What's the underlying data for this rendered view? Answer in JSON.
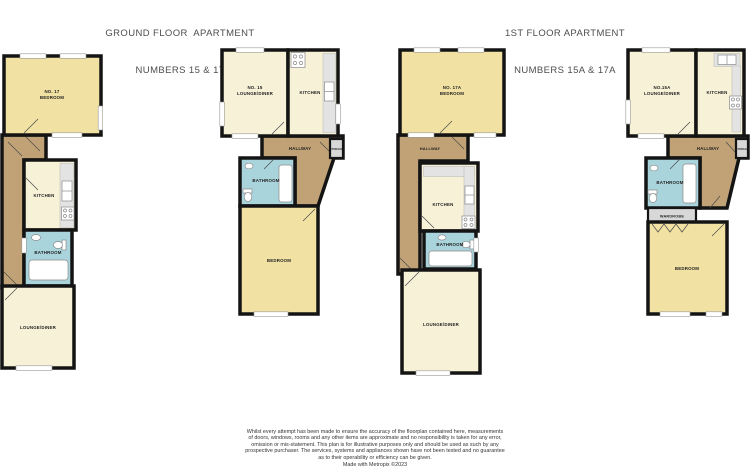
{
  "titles": [
    {
      "line1": "GROUND FLOOR  APARTMENT",
      "line2": "NUMBERS 15 & 17"
    },
    {
      "line1": "1ST FLOOR APARTMENT",
      "line2": "NUMBERS 15A & 17A"
    }
  ],
  "colors": {
    "bedroom": "#f1e1a2",
    "cream": "#f7f1d7",
    "hallway": "#c1a276",
    "bathroom": "#aad4dc",
    "storage": "#d8d8d8",
    "wardrobe": "#d8d8d8"
  },
  "plans": [
    {
      "id": "ground-no-17",
      "labels": {
        "unit_line1": "NO. 17",
        "unit_line2": "BEDROOM",
        "kitchen": "KITCHEN",
        "bathroom": "BATHROOM",
        "lounge": "LOUNGE/DINER"
      }
    },
    {
      "id": "ground-no-15",
      "labels": {
        "unit_line1": "NO. 15",
        "unit_line2": "LOUNGE/DINER",
        "kitchen": "KITCHEN",
        "hallway": "HALLWAY",
        "storage": "STORAGE",
        "bathroom": "BATHROOM",
        "bedroom": "BEDROOM"
      }
    },
    {
      "id": "first-no-17a",
      "labels": {
        "unit_line1": "NO. 17A",
        "unit_line2": "BEDROOM",
        "hallway": "HALLWAY",
        "kitchen": "KITCHEN",
        "bathroom": "BATHROOM",
        "lounge": "LOUNGE/DINER"
      }
    },
    {
      "id": "first-no-15a",
      "labels": {
        "unit_line1": "NO.15A",
        "unit_line2": "LOUNGE/DINER",
        "kitchen": "KITCHEN",
        "hallway": "HALLWAY",
        "storage": "STORAGE",
        "bathroom": "BATHROOM",
        "wardrobe": "WARDROBE",
        "bedroom": "BEDROOM"
      }
    }
  ],
  "disclaimer": {
    "lines": [
      "Whilst every attempt has been made to ensure the accuracy of the floorplan contained here, measurements",
      "of doors, windows, rooms and any other items are approximate and no responsibility is taken for any error,",
      "omission or mis-statement. This plan is for illustrative purposes only and should be used as such by any",
      "prospective purchaser. The services, systems and appliances shown have not been tested and no guarantee",
      "as to their operability or efficiency can be given."
    ],
    "credit": "Made with Metropix ©2023"
  }
}
